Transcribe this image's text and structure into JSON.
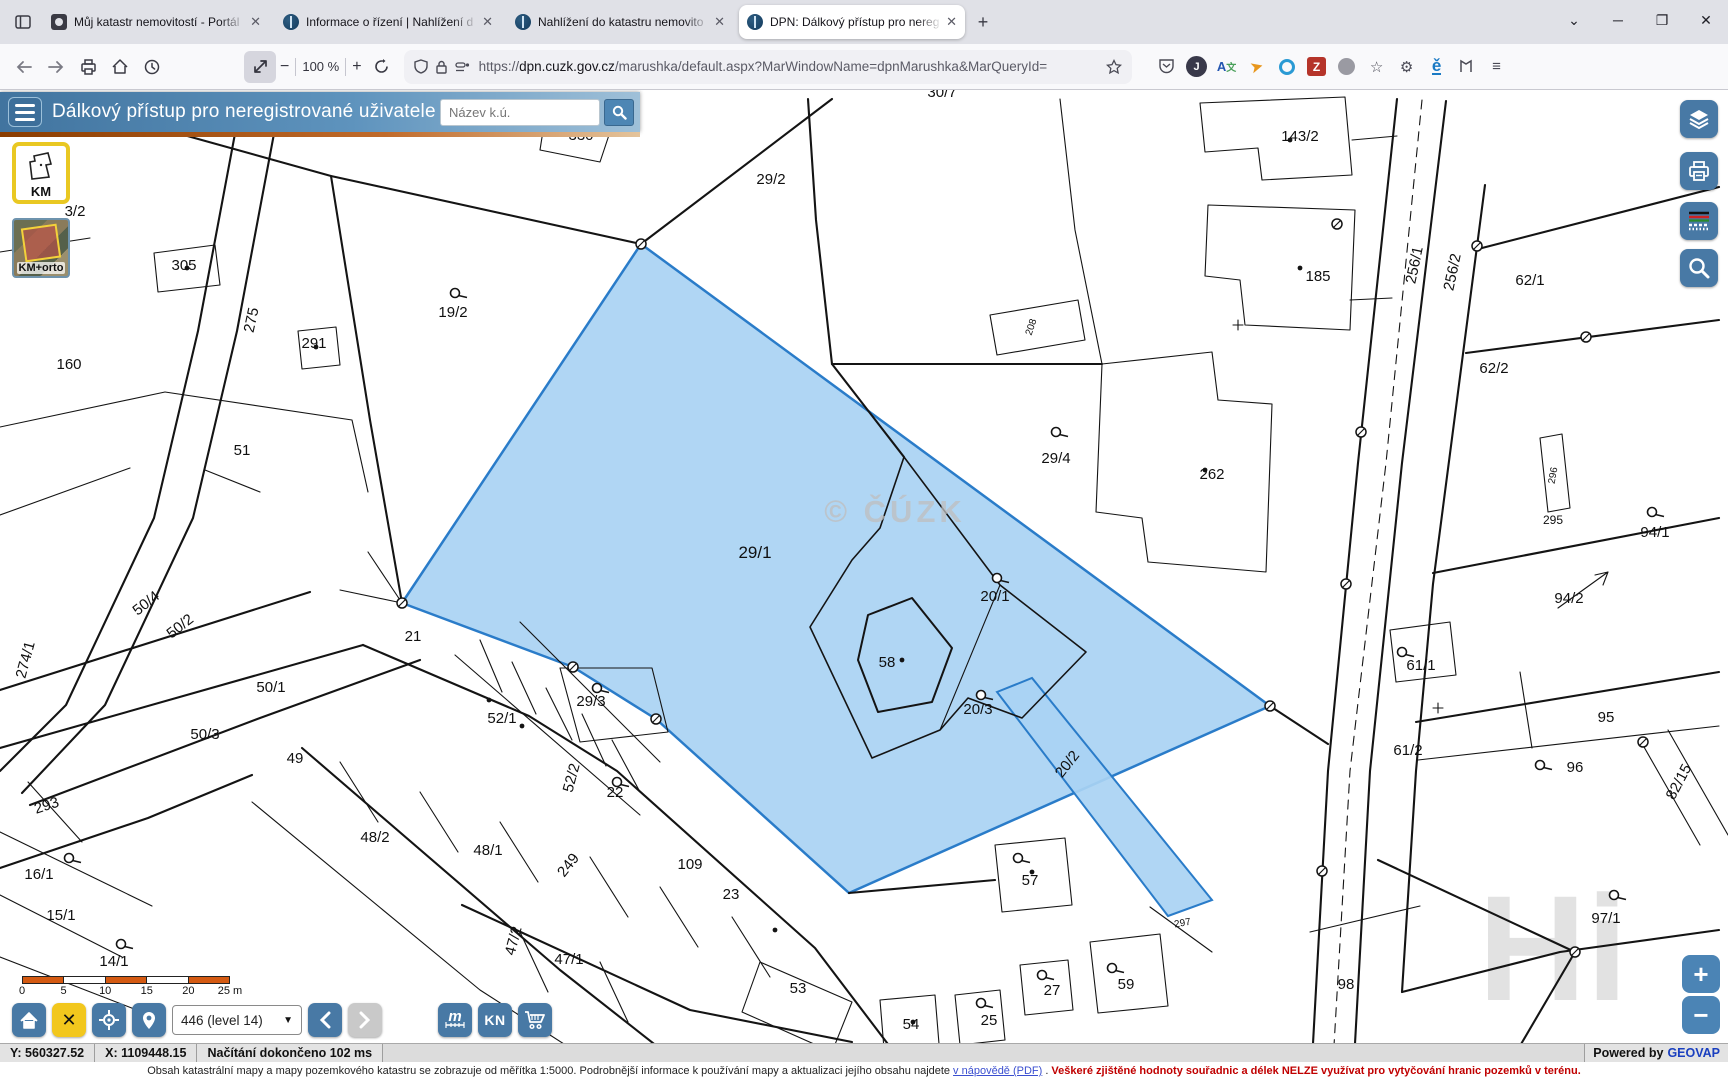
{
  "browser": {
    "tabs": [
      {
        "title": "Můj katastr nemovitostí - Portál"
      },
      {
        "title": "Informace o řízení | Nahlížení d"
      },
      {
        "title": "Nahlížení do katastru nemovito"
      },
      {
        "title": "DPN: Dálkový přístup pro nereg"
      }
    ],
    "new_tab": "+",
    "close_glyph": "✕",
    "zoom_percent": "100 %",
    "url_scheme": "https://",
    "url_domain": "dpn.cuzk.gov.cz",
    "url_path": "/marushka/default.aspx?MarWindowName=dpnMarushka&MarQueryId="
  },
  "header": {
    "title": "Dálkový přístup pro neregistrované uživatele",
    "search_placeholder": "Název k.ú."
  },
  "layers": {
    "km_label": "KM",
    "kmorto_label": "KM+orto"
  },
  "map": {
    "watermark": "© ČÚZK",
    "hi_watermark": "Hi",
    "highlight_fill": "#a9d2f3",
    "highlight_stroke": "#2a7cc9",
    "parcels": [
      {
        "label": "330",
        "x": 581,
        "y": 140
      },
      {
        "label": "29/2",
        "x": 771,
        "y": 184
      },
      {
        "label": "30/7",
        "x": 942,
        "y": 97
      },
      {
        "label": "143/2",
        "x": 1300,
        "y": 141
      },
      {
        "label": "185",
        "x": 1318,
        "y": 281
      },
      {
        "label": "256/1",
        "x": 1419,
        "y": 266,
        "r": -78
      },
      {
        "label": "256/2",
        "x": 1457,
        "y": 273,
        "r": -78
      },
      {
        "label": "62/1",
        "x": 1530,
        "y": 285
      },
      {
        "label": "62/2",
        "x": 1494,
        "y": 373
      },
      {
        "label": "296",
        "x": 1556,
        "y": 476,
        "r": -80,
        "fs": 10
      },
      {
        "label": "295",
        "x": 1553,
        "y": 524,
        "fs": 12
      },
      {
        "label": "94/1",
        "x": 1655,
        "y": 537
      },
      {
        "label": "94/2",
        "x": 1569,
        "y": 603
      },
      {
        "label": "3/2",
        "x": 75,
        "y": 216
      },
      {
        "label": "305",
        "x": 184,
        "y": 270
      },
      {
        "label": "291",
        "x": 314,
        "y": 348
      },
      {
        "label": "160",
        "x": 69,
        "y": 369
      },
      {
        "label": "275",
        "x": 256,
        "y": 321,
        "r": -78
      },
      {
        "label": "51",
        "x": 242,
        "y": 455
      },
      {
        "label": "19/2",
        "x": 453,
        "y": 317
      },
      {
        "label": "29/1",
        "x": 755,
        "y": 558,
        "fs": 17
      },
      {
        "label": "29/4",
        "x": 1056,
        "y": 463
      },
      {
        "label": "262",
        "x": 1212,
        "y": 479
      },
      {
        "label": "208",
        "x": 1034,
        "y": 328,
        "r": -72,
        "fs": 10
      },
      {
        "label": "20/1",
        "x": 995,
        "y": 601
      },
      {
        "label": "58",
        "x": 887,
        "y": 667
      },
      {
        "label": "20/3",
        "x": 978,
        "y": 714
      },
      {
        "label": "20/2",
        "x": 1071,
        "y": 767,
        "r": -52
      },
      {
        "label": "21",
        "x": 413,
        "y": 641
      },
      {
        "label": "29/3",
        "x": 591,
        "y": 706
      },
      {
        "label": "52/1",
        "x": 502,
        "y": 723
      },
      {
        "label": "52/2",
        "x": 576,
        "y": 779,
        "r": -75
      },
      {
        "label": "22",
        "x": 615,
        "y": 797
      },
      {
        "label": "50/4",
        "x": 149,
        "y": 607,
        "r": -38
      },
      {
        "label": "50/2",
        "x": 183,
        "y": 630,
        "r": -38
      },
      {
        "label": "50/1",
        "x": 271,
        "y": 692
      },
      {
        "label": "50/3",
        "x": 205,
        "y": 739
      },
      {
        "label": "49",
        "x": 295,
        "y": 763
      },
      {
        "label": "274/1",
        "x": 30,
        "y": 661,
        "r": -75
      },
      {
        "label": "48/2",
        "x": 375,
        "y": 842
      },
      {
        "label": "48/1",
        "x": 488,
        "y": 855
      },
      {
        "label": "249",
        "x": 572,
        "y": 868,
        "r": -52
      },
      {
        "label": "109",
        "x": 690,
        "y": 869
      },
      {
        "label": "23",
        "x": 731,
        "y": 899
      },
      {
        "label": "293",
        "x": 48,
        "y": 810,
        "r": -18
      },
      {
        "label": "16/1",
        "x": 39,
        "y": 879
      },
      {
        "label": "15/1",
        "x": 61,
        "y": 920
      },
      {
        "label": "14/1",
        "x": 114,
        "y": 966
      },
      {
        "label": "47/2",
        "x": 518,
        "y": 942,
        "r": -75
      },
      {
        "label": "47/1",
        "x": 569,
        "y": 964
      },
      {
        "label": "53",
        "x": 798,
        "y": 993
      },
      {
        "label": "54",
        "x": 911,
        "y": 1029
      },
      {
        "label": "25",
        "x": 989,
        "y": 1025
      },
      {
        "label": "27",
        "x": 1052,
        "y": 995
      },
      {
        "label": "57",
        "x": 1030,
        "y": 885
      },
      {
        "label": "59",
        "x": 1126,
        "y": 989
      },
      {
        "label": "297",
        "x": 1183,
        "y": 926,
        "fs": 10,
        "r": -10
      },
      {
        "label": "61/1",
        "x": 1421,
        "y": 670
      },
      {
        "label": "61/2",
        "x": 1408,
        "y": 755
      },
      {
        "label": "95",
        "x": 1606,
        "y": 722
      },
      {
        "label": "96",
        "x": 1575,
        "y": 772
      },
      {
        "label": "82/15",
        "x": 1683,
        "y": 784,
        "r": -62
      },
      {
        "label": "97/1",
        "x": 1606,
        "y": 923
      },
      {
        "label": "98",
        "x": 1346,
        "y": 989
      }
    ],
    "symbols": [
      [
        455,
        293
      ],
      [
        597,
        688
      ],
      [
        617,
        782
      ],
      [
        997,
        578
      ],
      [
        981,
        695
      ],
      [
        1056,
        432
      ],
      [
        69,
        858
      ],
      [
        121,
        944
      ],
      [
        1652,
        512
      ],
      [
        1614,
        895
      ],
      [
        1540,
        765
      ],
      [
        1402,
        652
      ],
      [
        1018,
        858
      ],
      [
        1112,
        968
      ],
      [
        1042,
        975
      ],
      [
        981,
        1003
      ]
    ],
    "markers": [
      [
        641,
        244
      ],
      [
        402,
        603
      ],
      [
        573,
        667
      ],
      [
        656,
        719
      ],
      [
        1270,
        706
      ],
      [
        1337,
        224
      ],
      [
        1361,
        432
      ],
      [
        1346,
        584
      ],
      [
        1322,
        871
      ],
      [
        1477,
        246
      ],
      [
        1586,
        337
      ],
      [
        1643,
        742
      ],
      [
        1575,
        952
      ]
    ],
    "dots": [
      [
        187,
        268
      ],
      [
        316,
        347
      ],
      [
        902,
        660
      ],
      [
        1205,
        470
      ],
      [
        1300,
        268
      ],
      [
        1290,
        140
      ],
      [
        1032,
        872
      ],
      [
        489,
        700
      ],
      [
        522,
        726
      ],
      [
        913,
        1022
      ],
      [
        775,
        930
      ]
    ]
  },
  "bottombar": {
    "scale_ticks": [
      "0",
      "5",
      "10",
      "15",
      "20",
      "25 m"
    ],
    "scale_value": "446 (level 14)",
    "kn_label": "KN",
    "measure_label": "m"
  },
  "statusbar": {
    "coord_y": "Y: 560327.52",
    "coord_x": "X: 1109448.15",
    "status": "Načítání dokončeno 102 ms",
    "powered_by": "Powered by",
    "powered_link": "GEOVAP"
  },
  "footer": {
    "text_before": "Obsah katastrální mapy a mapy pozemkového katastru se zobrazuje od měřítka 1:5000. Podrobnější informace k používání mapy a aktualizaci jejího obsahu najdete",
    "link": "v nápovědě (PDF)",
    "dot": ".",
    "text_red": "Veškeré zjištěné hodnoty souřadnic a délek NELZE využívat pro vytyčování hranic pozemků v terénu."
  }
}
